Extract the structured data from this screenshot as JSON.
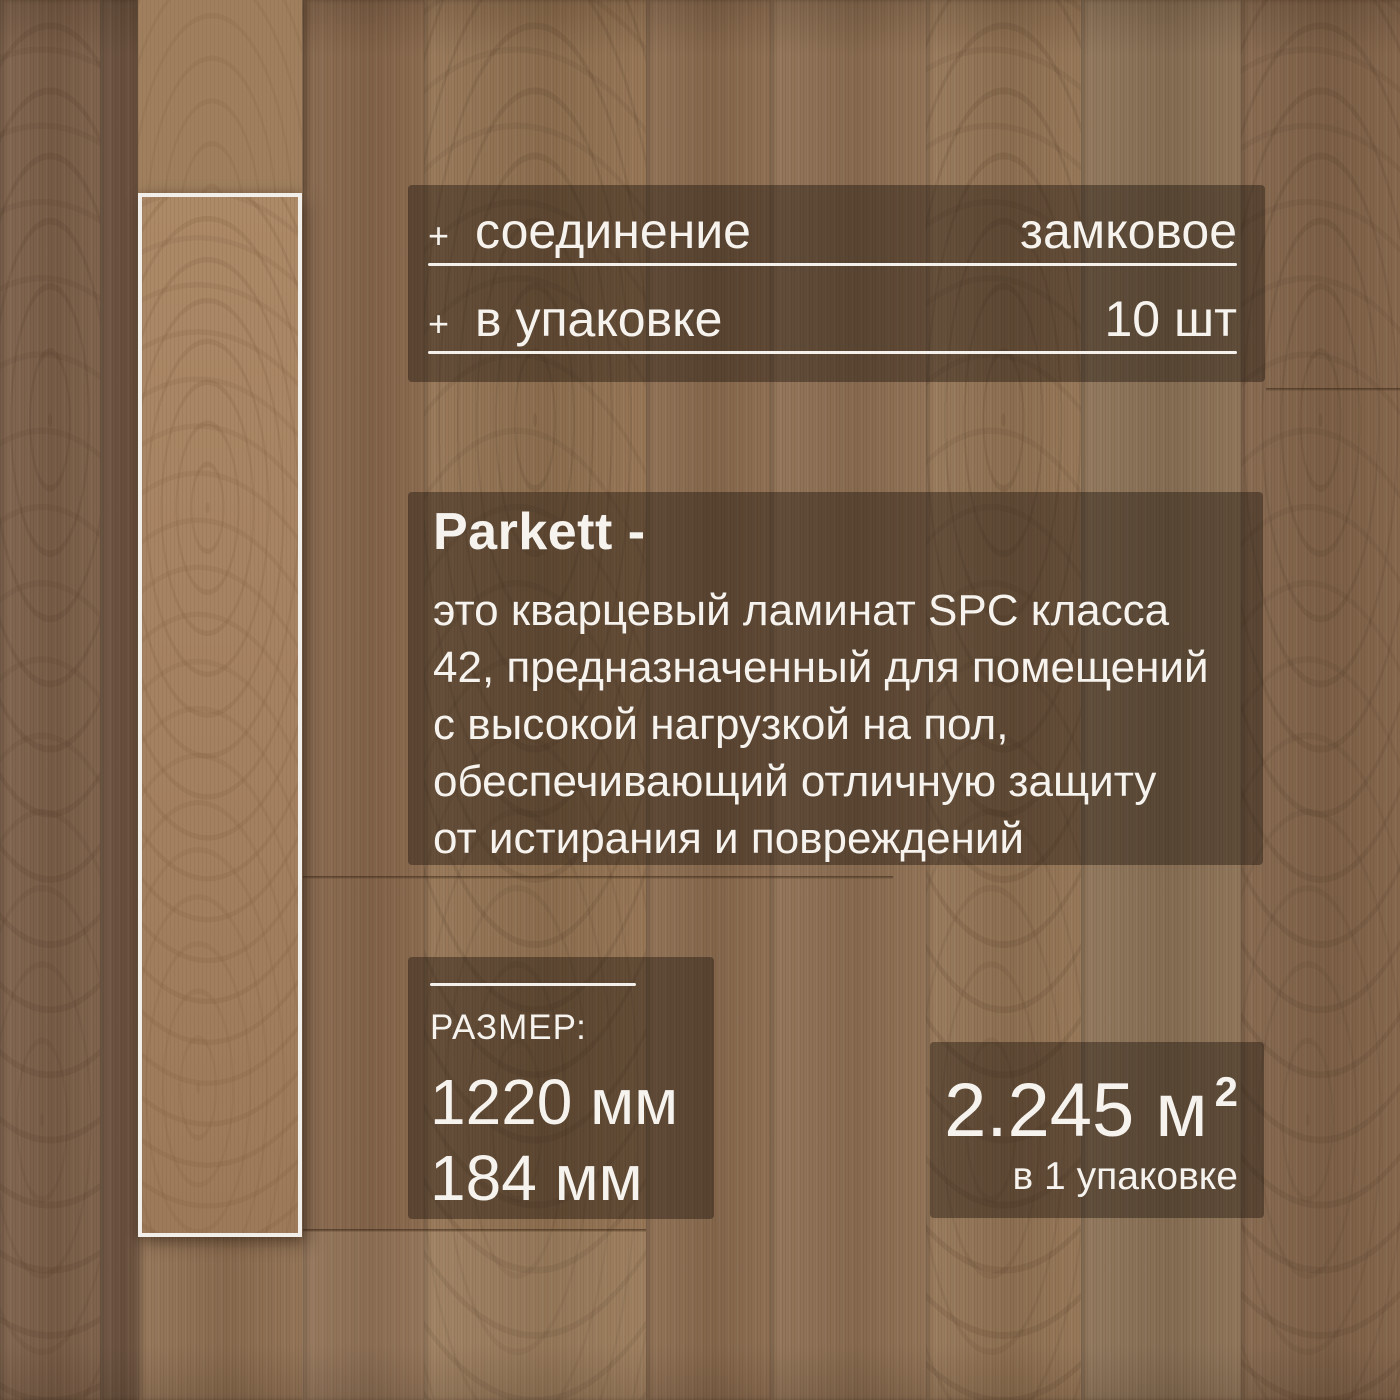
{
  "specs_panel": {
    "rows": [
      {
        "bullet": "+",
        "label": "соединение",
        "value": "замковое"
      },
      {
        "bullet": "+",
        "label": "в упаковке",
        "value": "10 шт"
      }
    ]
  },
  "description_panel": {
    "heading": "Parkett -",
    "lines": [
      "это кварцевый ламинат SPC класса",
      "42, предназначенный для помещений",
      "с высокой нагрузкой на пол,",
      "обеспечивающий отличную защиту",
      "от истирания и повреждений"
    ]
  },
  "size_panel": {
    "label": "РАЗМЕР:",
    "values": [
      "1220 мм",
      "184 мм"
    ]
  },
  "coverage_panel": {
    "amount": "2.245 м",
    "superscript": "2",
    "note": "в 1 упаковке"
  },
  "colors": {
    "panel_overlay": "rgba(28,18,11,0.42)",
    "text": "#f6f3ee",
    "divider": "#f4f1ec",
    "wood_base": "#8b6b4e",
    "wood_dark": "#6e5440",
    "wood_light": "#967656",
    "sample_plank_wood": "#aa8766",
    "plank_frame": "#f2efeb"
  }
}
